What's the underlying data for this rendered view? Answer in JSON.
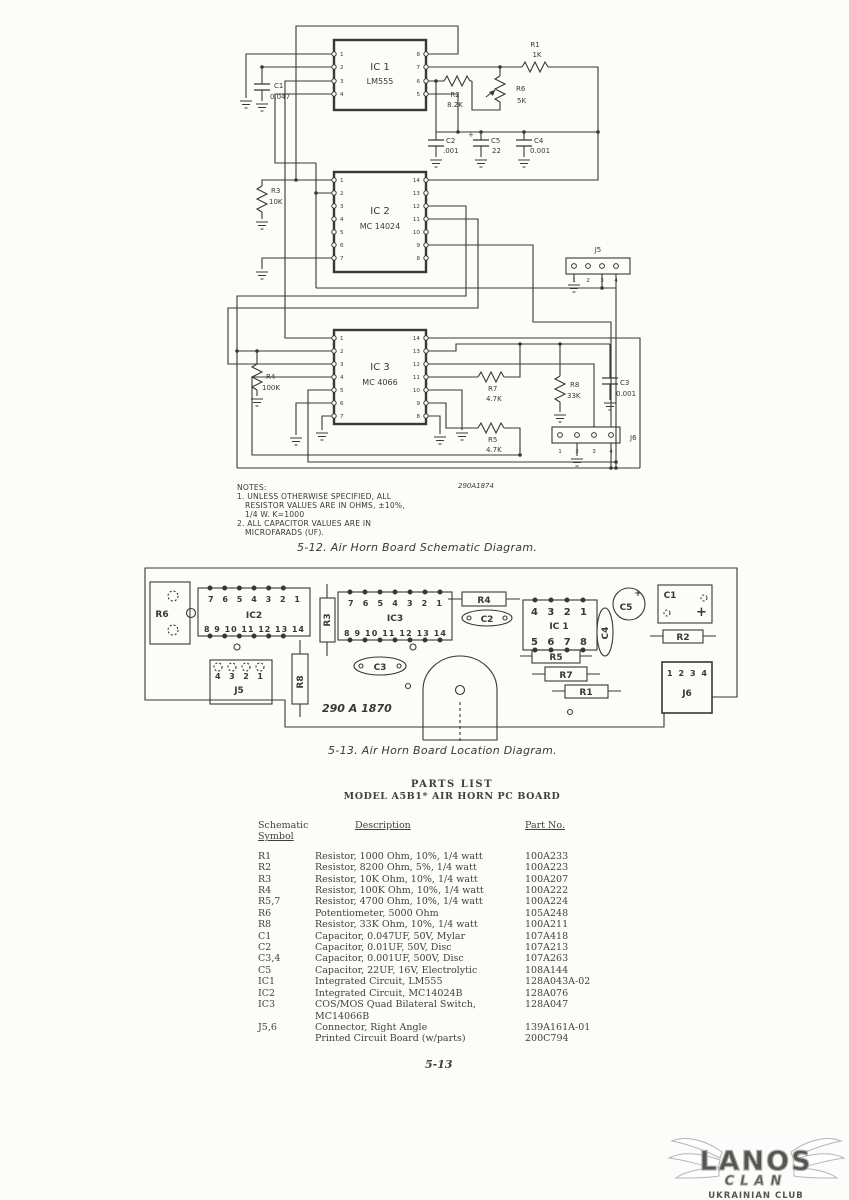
{
  "page": {
    "number": "5-13"
  },
  "schematic": {
    "caption": "5-12.  Air Horn Board Schematic Diagram.",
    "drawing_number": "290A1874",
    "notes": {
      "title": "NOTES:",
      "n1a": "1. UNLESS OTHERWISE SPECIFIED, ALL",
      "n1b": "RESISTOR VALUES ARE IN OHMS, ±10%,",
      "n1c": "1/4 W.  K=1000",
      "n2a": "2. ALL CAPACITOR VALUES ARE IN",
      "n2b": "MICROFARADS (UF)."
    },
    "ic1": {
      "ref": "IC 1",
      "part": "LM555"
    },
    "ic2": {
      "ref": "IC 2",
      "part": "MC 14024"
    },
    "ic3": {
      "ref": "IC 3",
      "part": "MC 4066"
    },
    "r1": {
      "ref": "R1",
      "value": "1K"
    },
    "r2": {
      "ref": "R2",
      "value": "8.2K"
    },
    "r3": {
      "ref": "R3",
      "value": "10K"
    },
    "r4": {
      "ref": "R4",
      "value": "100K"
    },
    "r5": {
      "ref": "R5",
      "value": "4.7K"
    },
    "r6": {
      "ref": "R6",
      "value": "5K"
    },
    "r7": {
      "ref": "R7",
      "value": "4.7K"
    },
    "r8": {
      "ref": "R8",
      "value": "33K"
    },
    "c1": {
      "ref": "C1",
      "value": "0.047"
    },
    "c2": {
      "ref": "C2",
      "value": ".001"
    },
    "c3": {
      "ref": "C3",
      "value": "0.001"
    },
    "c4": {
      "ref": "C4",
      "value": "0.001"
    },
    "c5": {
      "ref": "C5",
      "value": "22",
      "polarity": "+"
    },
    "j5": {
      "ref": "J5"
    },
    "j6": {
      "ref": "J6"
    },
    "pins": {
      "ic1_left": [
        "1",
        "2",
        "3",
        "4"
      ],
      "ic1_right": [
        "8",
        "7",
        "6",
        "5"
      ],
      "ic2_left": [
        "1",
        "2",
        "3",
        "4",
        "5",
        "6",
        "7"
      ],
      "ic2_right": [
        "14",
        "13",
        "12",
        "11",
        "10",
        "9",
        "8"
      ],
      "ic3_left": [
        "1",
        "2",
        "3",
        "4",
        "5",
        "6",
        "7"
      ],
      "ic3_right": [
        "14",
        "13",
        "12",
        "11",
        "10",
        "9",
        "8"
      ],
      "j5": [
        "1",
        "2",
        "3",
        "4"
      ],
      "j6": [
        "1",
        "2",
        "3",
        "4"
      ]
    }
  },
  "board": {
    "caption": "5-13.  Air Horn Board Location Diagram.",
    "board_number": "290 A 1870",
    "labels": {
      "r6": "R6",
      "ic2": "IC2",
      "r3": "R3",
      "j5": "J5",
      "r8": "R8",
      "ic3": "IC3",
      "c3": "C3",
      "r4": "R4",
      "c2": "C2",
      "ic1": "IC 1",
      "c4": "C4",
      "c5": "C5",
      "c1": "C1",
      "r2": "R2",
      "r5": "R5",
      "r7": "R7",
      "r1": "R1",
      "j6": "J6",
      "c1_plus": "+",
      "c5_star": "+"
    },
    "pins": {
      "ic2_top": "7 6 5 4 3 2 1",
      "ic2_bottom": "8 9 10 11 12 13 14",
      "ic3_top": "7 6 5 4 3 2 1",
      "ic3_bottom": "8 9 10 11 12 13 14",
      "ic1_top": "4 3 2 1",
      "ic1_bottom": "5 6 7 8",
      "j5": "4 3 2 1",
      "j6": "1 2 3 4"
    }
  },
  "parts_list": {
    "title": "PARTS LIST",
    "subtitle": "MODEL A5B1* AIR HORN PC BOARD",
    "headers": {
      "col1a": "Schematic",
      "col1b": "Symbol",
      "col2": "Description",
      "col3": "Part No."
    },
    "rows": [
      {
        "symbol": "R1",
        "description": "Resistor, 1000 Ohm, 10%, 1/4 watt",
        "part_no": "100A233"
      },
      {
        "symbol": "R2",
        "description": "Resistor, 8200 Ohm, 5%, 1/4 watt",
        "part_no": "100A223"
      },
      {
        "symbol": "R3",
        "description": "Resistor, 10K Ohm, 10%, 1/4 watt",
        "part_no": "100A207"
      },
      {
        "symbol": "R4",
        "description": "Resistor, 100K Ohm, 10%, 1/4 watt",
        "part_no": "100A222"
      },
      {
        "symbol": "R5,7",
        "description": "Resistor, 4700 Ohm, 10%, 1/4 watt",
        "part_no": "100A224"
      },
      {
        "symbol": "R6",
        "description": "Potentiometer, 5000 Ohm",
        "part_no": "105A248"
      },
      {
        "symbol": "R8",
        "description": "Resistor, 33K Ohm, 10%, 1/4 watt",
        "part_no": "100A211"
      },
      {
        "symbol": "C1",
        "description": "Capacitor, 0.047UF, 50V, Mylar",
        "part_no": "107A418"
      },
      {
        "symbol": "C2",
        "description": "Capacitor, 0.01UF, 50V, Disc",
        "part_no": "107A213"
      },
      {
        "symbol": "C3,4",
        "description": "Capacitor, 0.001UF, 500V, Disc",
        "part_no": "107A263"
      },
      {
        "symbol": "C5",
        "description": "Capacitor, 22UF, 16V, Electrolytic",
        "part_no": "108A144"
      },
      {
        "symbol": "IC1",
        "description": "Integrated Circuit, LM555",
        "part_no": "128A043A-02"
      },
      {
        "symbol": "IC2",
        "description": "Integrated Circuit, MC14024B",
        "part_no": "128A076"
      },
      {
        "symbol": "IC3",
        "description": "COS/MOS Quad Bilateral Switch, MC14066B",
        "part_no": "128A047"
      },
      {
        "symbol": "J5,6",
        "description": "Connector, Right Angle",
        "part_no": "139A161A-01"
      },
      {
        "symbol": "",
        "description": "Printed Circuit Board (w/parts)",
        "part_no": "200C794"
      }
    ]
  },
  "watermark": {
    "title": "LANOS",
    "subtitle": "CLAN",
    "tagline": "UKRAINIAN CLUB"
  }
}
